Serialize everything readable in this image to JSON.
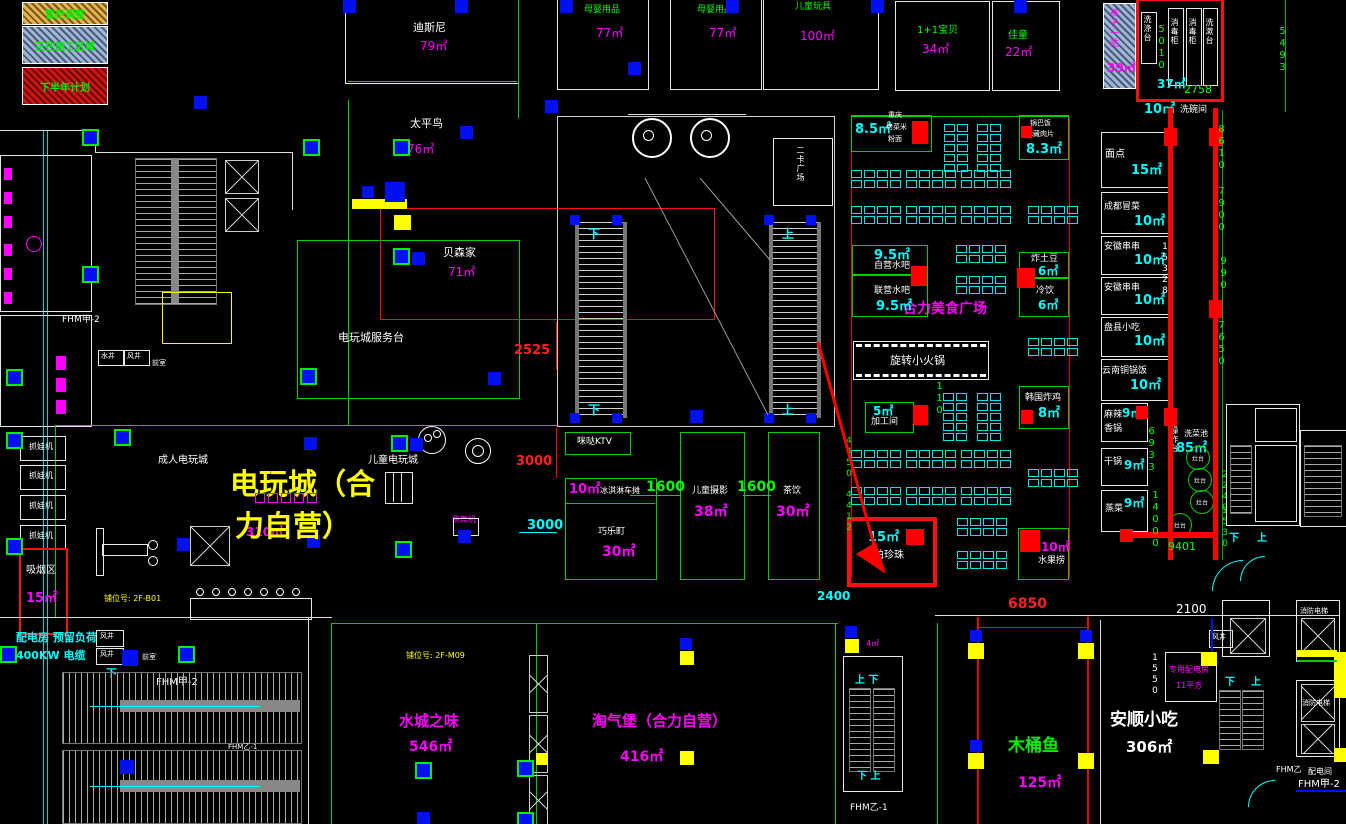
{
  "legend": {
    "items": [
      {
        "label": "暂柜调整",
        "color": "#e8b34a"
      },
      {
        "label": "正在施工区域",
        "color": "#9db7dc"
      },
      {
        "label": "下半年计划",
        "color": "#cc1414"
      }
    ]
  },
  "shops": {
    "disney": {
      "name": "迪斯尼",
      "area": "79㎡"
    },
    "taipingniao": {
      "name": "太平鸟",
      "area": "76㎡"
    },
    "beisenjia": {
      "name": "贝森家",
      "area": "71㎡"
    },
    "fuwutai": {
      "name": "电玩城服务台"
    },
    "muying1": {
      "name": "母婴用品",
      "area": "77㎡"
    },
    "muying2": {
      "name": "母婴用品",
      "area": "77㎡"
    },
    "wanju": {
      "name": "儿童玩具",
      "area": "100㎡"
    },
    "baobei": {
      "name": "1+1宝贝",
      "area": "34㎡"
    },
    "jiatong": {
      "name": "佳童",
      "area": "22㎡"
    },
    "wazi": {
      "name": "袜子一贴",
      "area": "39㎡"
    }
  },
  "washroom": {
    "room_area": "37㎡",
    "dish_area": "10㎡",
    "dish_name": "洗碗间",
    "sink1": "洗涤台",
    "sink2": "消毒柜",
    "sink3": "消毒柜",
    "sink4": "洗漱台"
  },
  "right_shops": [
    {
      "name": "面点",
      "area": "15㎡"
    },
    {
      "name": "成都冒菜",
      "area": "10㎡"
    },
    {
      "name": "安徽串串",
      "area": "10㎡"
    },
    {
      "name": "安徽串串",
      "area": "10㎡"
    },
    {
      "name": "盘县小吃",
      "area": "10㎡"
    },
    {
      "name": "云南铜锅饭",
      "area": "10㎡"
    },
    {
      "name": "麻辣香锅",
      "area": "9㎡"
    },
    {
      "name": "干锅",
      "area": "9㎡"
    },
    {
      "name": "蒸菜",
      "area": "9㎡"
    }
  ],
  "kitchen": {
    "station1": "操作台",
    "station2": "洗菜池",
    "area": "85㎡",
    "stove": "灶台"
  },
  "food_court": {
    "title": "合力美食广场",
    "chongqing": {
      "l1": "重庆",
      "l2": "烤菜米",
      "l3": "粉面",
      "area": "8.5㎡"
    },
    "guoba": {
      "l1": "锅巴饭",
      "l2": "冰藏肉片",
      "area": "8.3㎡"
    },
    "ziying": {
      "name": "自营水吧",
      "area": "9.5㎡"
    },
    "lianying": {
      "name": "联营水吧",
      "area": "9.5㎡"
    },
    "zhatudou": {
      "name": "炸土豆",
      "area": "6㎡"
    },
    "lengyin": {
      "name": "冷饮",
      "area": "6㎡"
    },
    "huoguo": {
      "name": "旋转小火锅"
    },
    "jiagong": {
      "name": "加工间",
      "area": "5㎡"
    },
    "hanguo": {
      "name": "韩国炸鸡",
      "area": "8㎡"
    },
    "papa": {
      "name": "帕帕珍珠",
      "area": "15㎡"
    },
    "shuiguo": {
      "name": "水果捞",
      "area": "10㎡"
    }
  },
  "arcade": {
    "title_line1": "电玩城（合",
    "title_line2": "力自营）",
    "area": "310㎡",
    "adult": "成人电玩城",
    "kids": "儿童电玩城",
    "ktv": "咪哒KTV",
    "claw": "抓娃机",
    "dance": "跳舞机",
    "smoking": {
      "name": "吸烟区",
      "area": "15㎡"
    },
    "booth1": "铺位号: 2F-B01",
    "booth2": "铺位号: 2F-M09"
  },
  "center_shops": {
    "icecream": {
      "name": "冰淇淋车摊",
      "area": "10㎡"
    },
    "qiaoleding": {
      "name": "巧乐町",
      "area": "30㎡"
    },
    "sheying": {
      "name": "儿童摄影",
      "area": "38㎡"
    },
    "chayin": {
      "name": "茶饮",
      "area": "30㎡"
    }
  },
  "bottom_shops": {
    "shuicheng": {
      "name": "水城之味",
      "area": "546㎡"
    },
    "taoqibao": {
      "name": "淘气堡（合力自营）",
      "area": "416㎡"
    },
    "mutongyu": {
      "name": "木桶鱼",
      "area": "125㎡"
    },
    "anshun": {
      "name": "安顺小吃",
      "area": "306㎡"
    }
  },
  "utility": {
    "power_room_l1": "配电房 预留负荷",
    "power_room_l2": "400KW 电缆",
    "power_room2_l1": "专用配电房",
    "power_room2_l2": "11平方",
    "fengjing": "风井",
    "shuijing": "水井",
    "qianshi": "前室",
    "peidianjian": "配电间",
    "fhm_jia2": "FHM甲-2",
    "fhm_yi1": "FHM乙-1",
    "fhm_yi": "FHM乙",
    "fire_elevator": "消防电梯",
    "erka": "二卡广场",
    "up": "上",
    "down": "下",
    "up_down": "上 下",
    "down_up": "下 上",
    "area4": "4㎡"
  },
  "dims": {
    "d2525": "2525",
    "d3000r": "3000",
    "d3000c": "3000",
    "d1600a": "1600",
    "d1600b": "1600",
    "d110": "110",
    "d4450": "4450",
    "d4412": "4412",
    "d2400": "2400",
    "d6850": "6850",
    "d2100": "2100",
    "d1550": "1550",
    "d5010": "5010",
    "d5493": "5493",
    "d2758": "2758",
    "d8610": "8610",
    "d7900": "7900",
    "d990": "990",
    "d7650": "7650",
    "d15328": "15328",
    "d6933": "6933",
    "d14000": "14000",
    "d9401": "9401",
    "d1530": "1530",
    "d2240": "2240"
  },
  "colors": {
    "bg": "#000000",
    "line_green": "#00ff00",
    "line_red": "#ff0000",
    "accent_cyan": "#00ffff",
    "accent_magenta": "#ff00ff",
    "accent_yellow": "#ffff00",
    "column_blue": "#0010ee"
  }
}
